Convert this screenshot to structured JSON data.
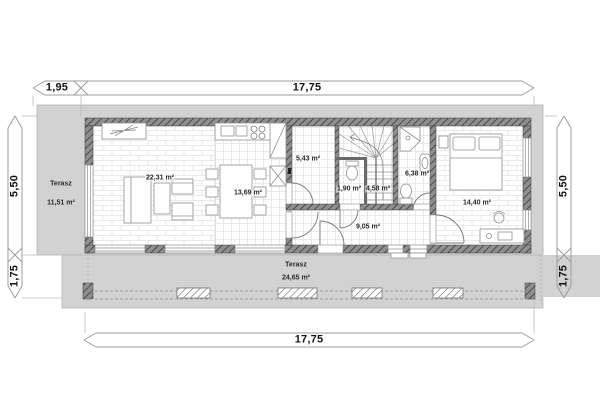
{
  "plan": {
    "dimensions": {
      "top_terrace_width": "1,95",
      "top_total_width": "17,75",
      "bottom_total_width": "17,75",
      "left_main_depth": "5,50",
      "left_terrace_depth": "1,75",
      "right_main_depth": "5,50",
      "right_terrace_depth": "1,75"
    },
    "rooms": {
      "terrace_left": {
        "name": "Terasz",
        "area": "11,51 m²"
      },
      "living_room": {
        "area": "22,31 m²"
      },
      "kitchen_dining": {
        "area": "13,69 m²"
      },
      "pantry": {
        "area": "5,43 m²"
      },
      "wc": {
        "area": "1,90 m²"
      },
      "staircase": {
        "area": "4,58 m²"
      },
      "bathroom": {
        "area": "6,38 m²"
      },
      "hall": {
        "area": "9,05 m²"
      },
      "bedroom": {
        "area": "14,40 m²"
      },
      "terrace_bottom": {
        "name": "Terasz",
        "area": "24,65 m²"
      }
    },
    "colors": {
      "slab": "#d2d2d2",
      "wall_dark": "#6e6e6e",
      "dimension_line": "#9c9c9c",
      "text": "#1b1b1b"
    }
  }
}
